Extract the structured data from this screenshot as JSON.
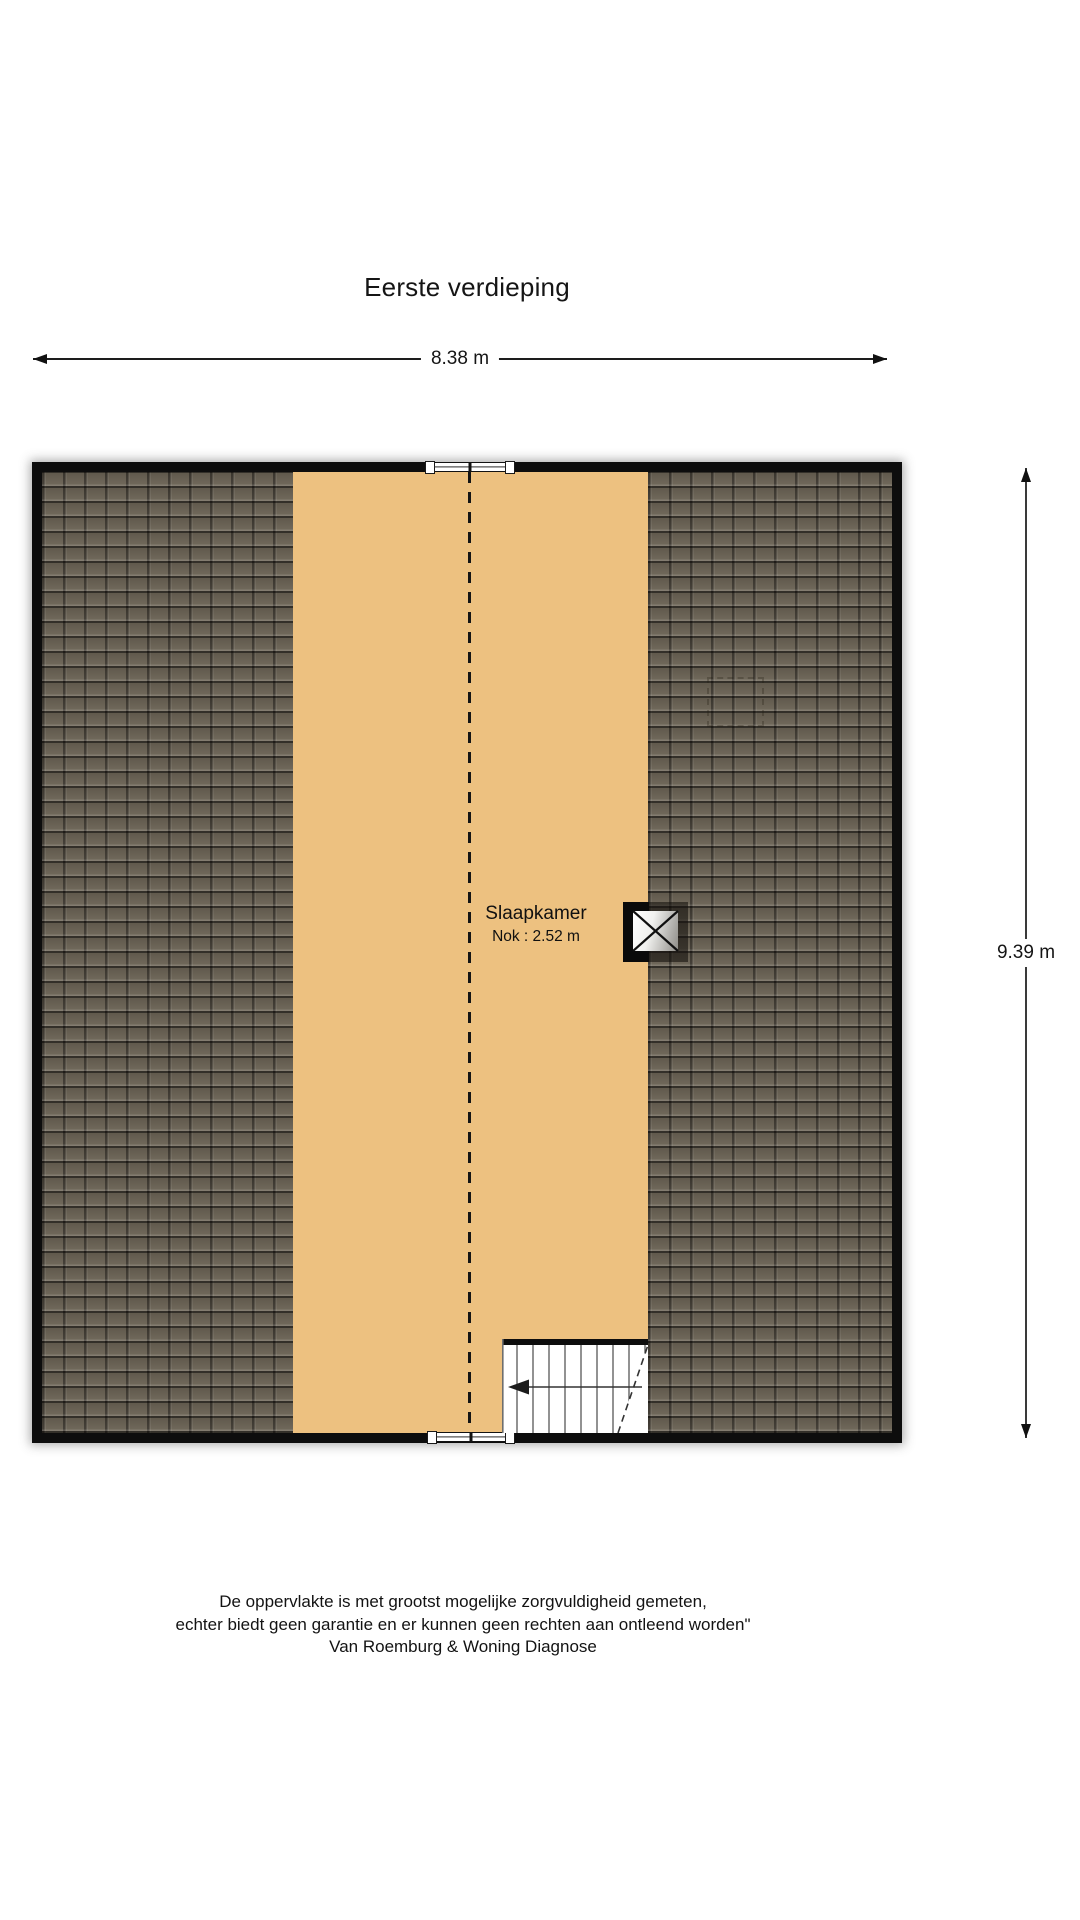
{
  "title": "Eerste verdieping",
  "dimensions": {
    "width": "8.38 m",
    "height": "9.39 m"
  },
  "room": {
    "name": "Slaapkamer",
    "ridge_height": "Nok : 2.52 m"
  },
  "disclaimer": {
    "line1": "De oppervlakte is met grootst mogelijke zorgvuldigheid gemeten,",
    "line2": "echter biedt geen garantie en er kunnen geen rechten aan ontleend worden\"",
    "line3": "Van Roemburg & Woning Diagnose"
  },
  "colors": {
    "floor": "#edc180",
    "roof_tile": "#6b6355",
    "roof_gap": "#3b362c",
    "wall": "#0d0d0d",
    "page_background": "#ffffff"
  }
}
